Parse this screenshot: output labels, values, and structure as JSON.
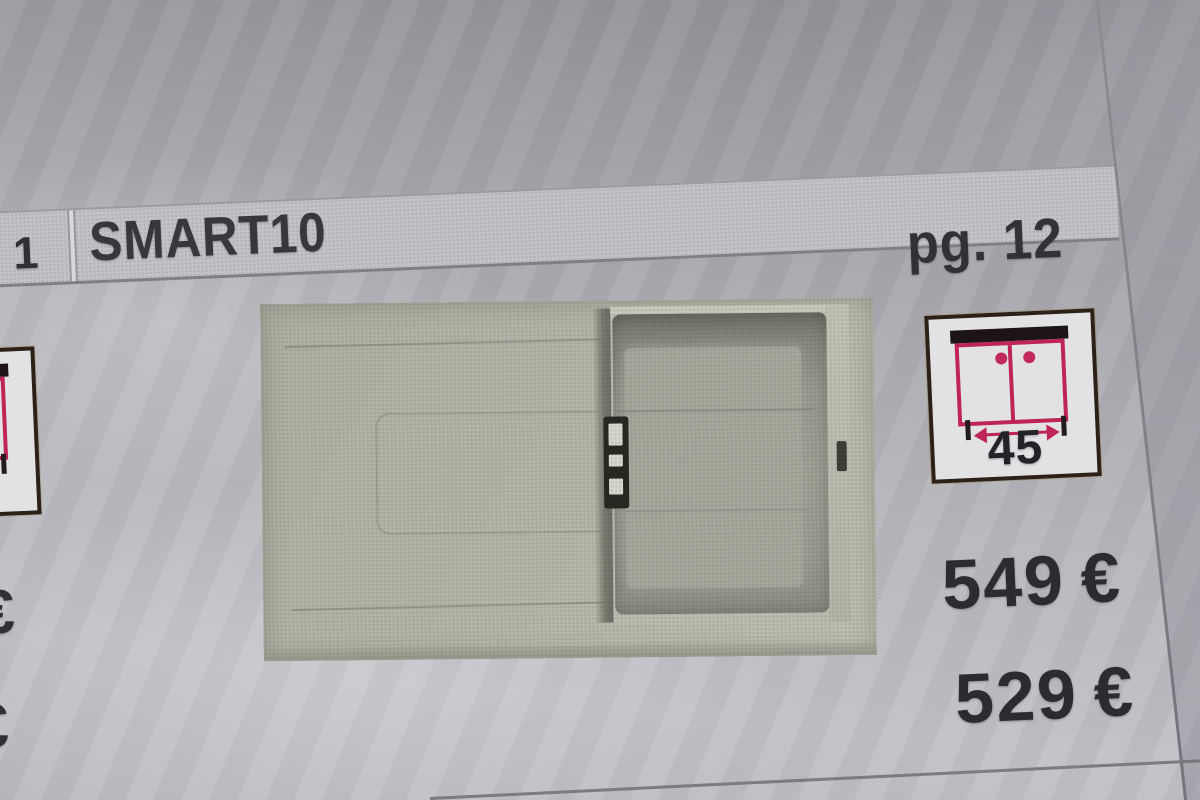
{
  "header": {
    "index": "1",
    "model": "SMART10",
    "page_ref": "pg. 12"
  },
  "size_icon": {
    "type": "base-cabinet-width-pictogram",
    "width_value": "45"
  },
  "prices": [
    {
      "amount": "549",
      "currency": "€"
    },
    {
      "amount": "529",
      "currency": "€"
    }
  ],
  "adjacent_column": {
    "partial_currency_top": "€",
    "partial_currency_bottom": "€"
  },
  "colors": {
    "accent_pink": "#bf2456",
    "icon_border_black": "#2b2119",
    "header_band_gray": "#c2c3c6",
    "text_dark": "#313136",
    "photo_surface_green_gray": "#b4b6a9",
    "paper_gray": "#b0b1b6"
  }
}
